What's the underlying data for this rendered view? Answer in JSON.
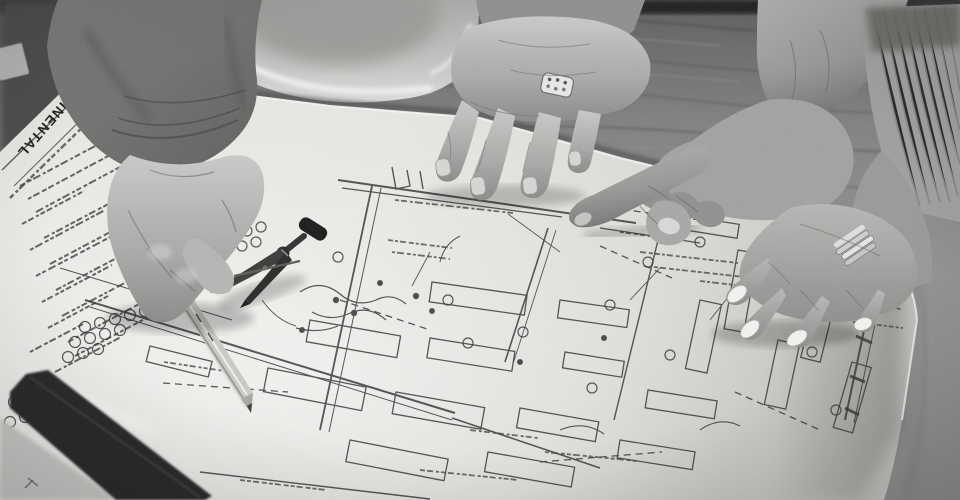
{
  "meta": {
    "kind": "black-and-white photograph",
    "description": "Three hands of construction professionals review an architectural electrical blueprint spread on a plywood table; a white hard hat sits behind the sheet, a sharpened pencil and a steel drafting compass lie on the drawing, one hand points at a plan detail and a woman's hand with a french manicure rests on the sheet edge."
  },
  "blueprint": {
    "edge_title": "CONTINENTAL",
    "plan_label": "POWER"
  },
  "objects": {
    "hard_hat": "white safety hard hat (upside-down brim)",
    "pencil": "sharpened wooden pencil with metal ferrule",
    "compass": "steel drafting compass with black knob",
    "sleeve_hand": "older man's hand in suede jacket sleeve holding the pencil",
    "resting_hand": "man's right hand with braided silver ring resting on the plan",
    "pointing_hand": "hand pointing with index finger at a plan detail",
    "manicured_hand": "woman's hand with french manicure and stacked silver rings, knit sweater cuff",
    "table": "plywood work table with dark front edge"
  },
  "palette": {
    "background_dark": "#262626",
    "plywood": "#7f7f7f",
    "paper_light": "#ecece9",
    "paper_shadow": "#c9c9c5",
    "ink": "#333333",
    "hat": "#c2c2c0",
    "skin_light": "#bcbcba",
    "skin_dark": "#7e7e7c",
    "table_edge": "#232323"
  }
}
